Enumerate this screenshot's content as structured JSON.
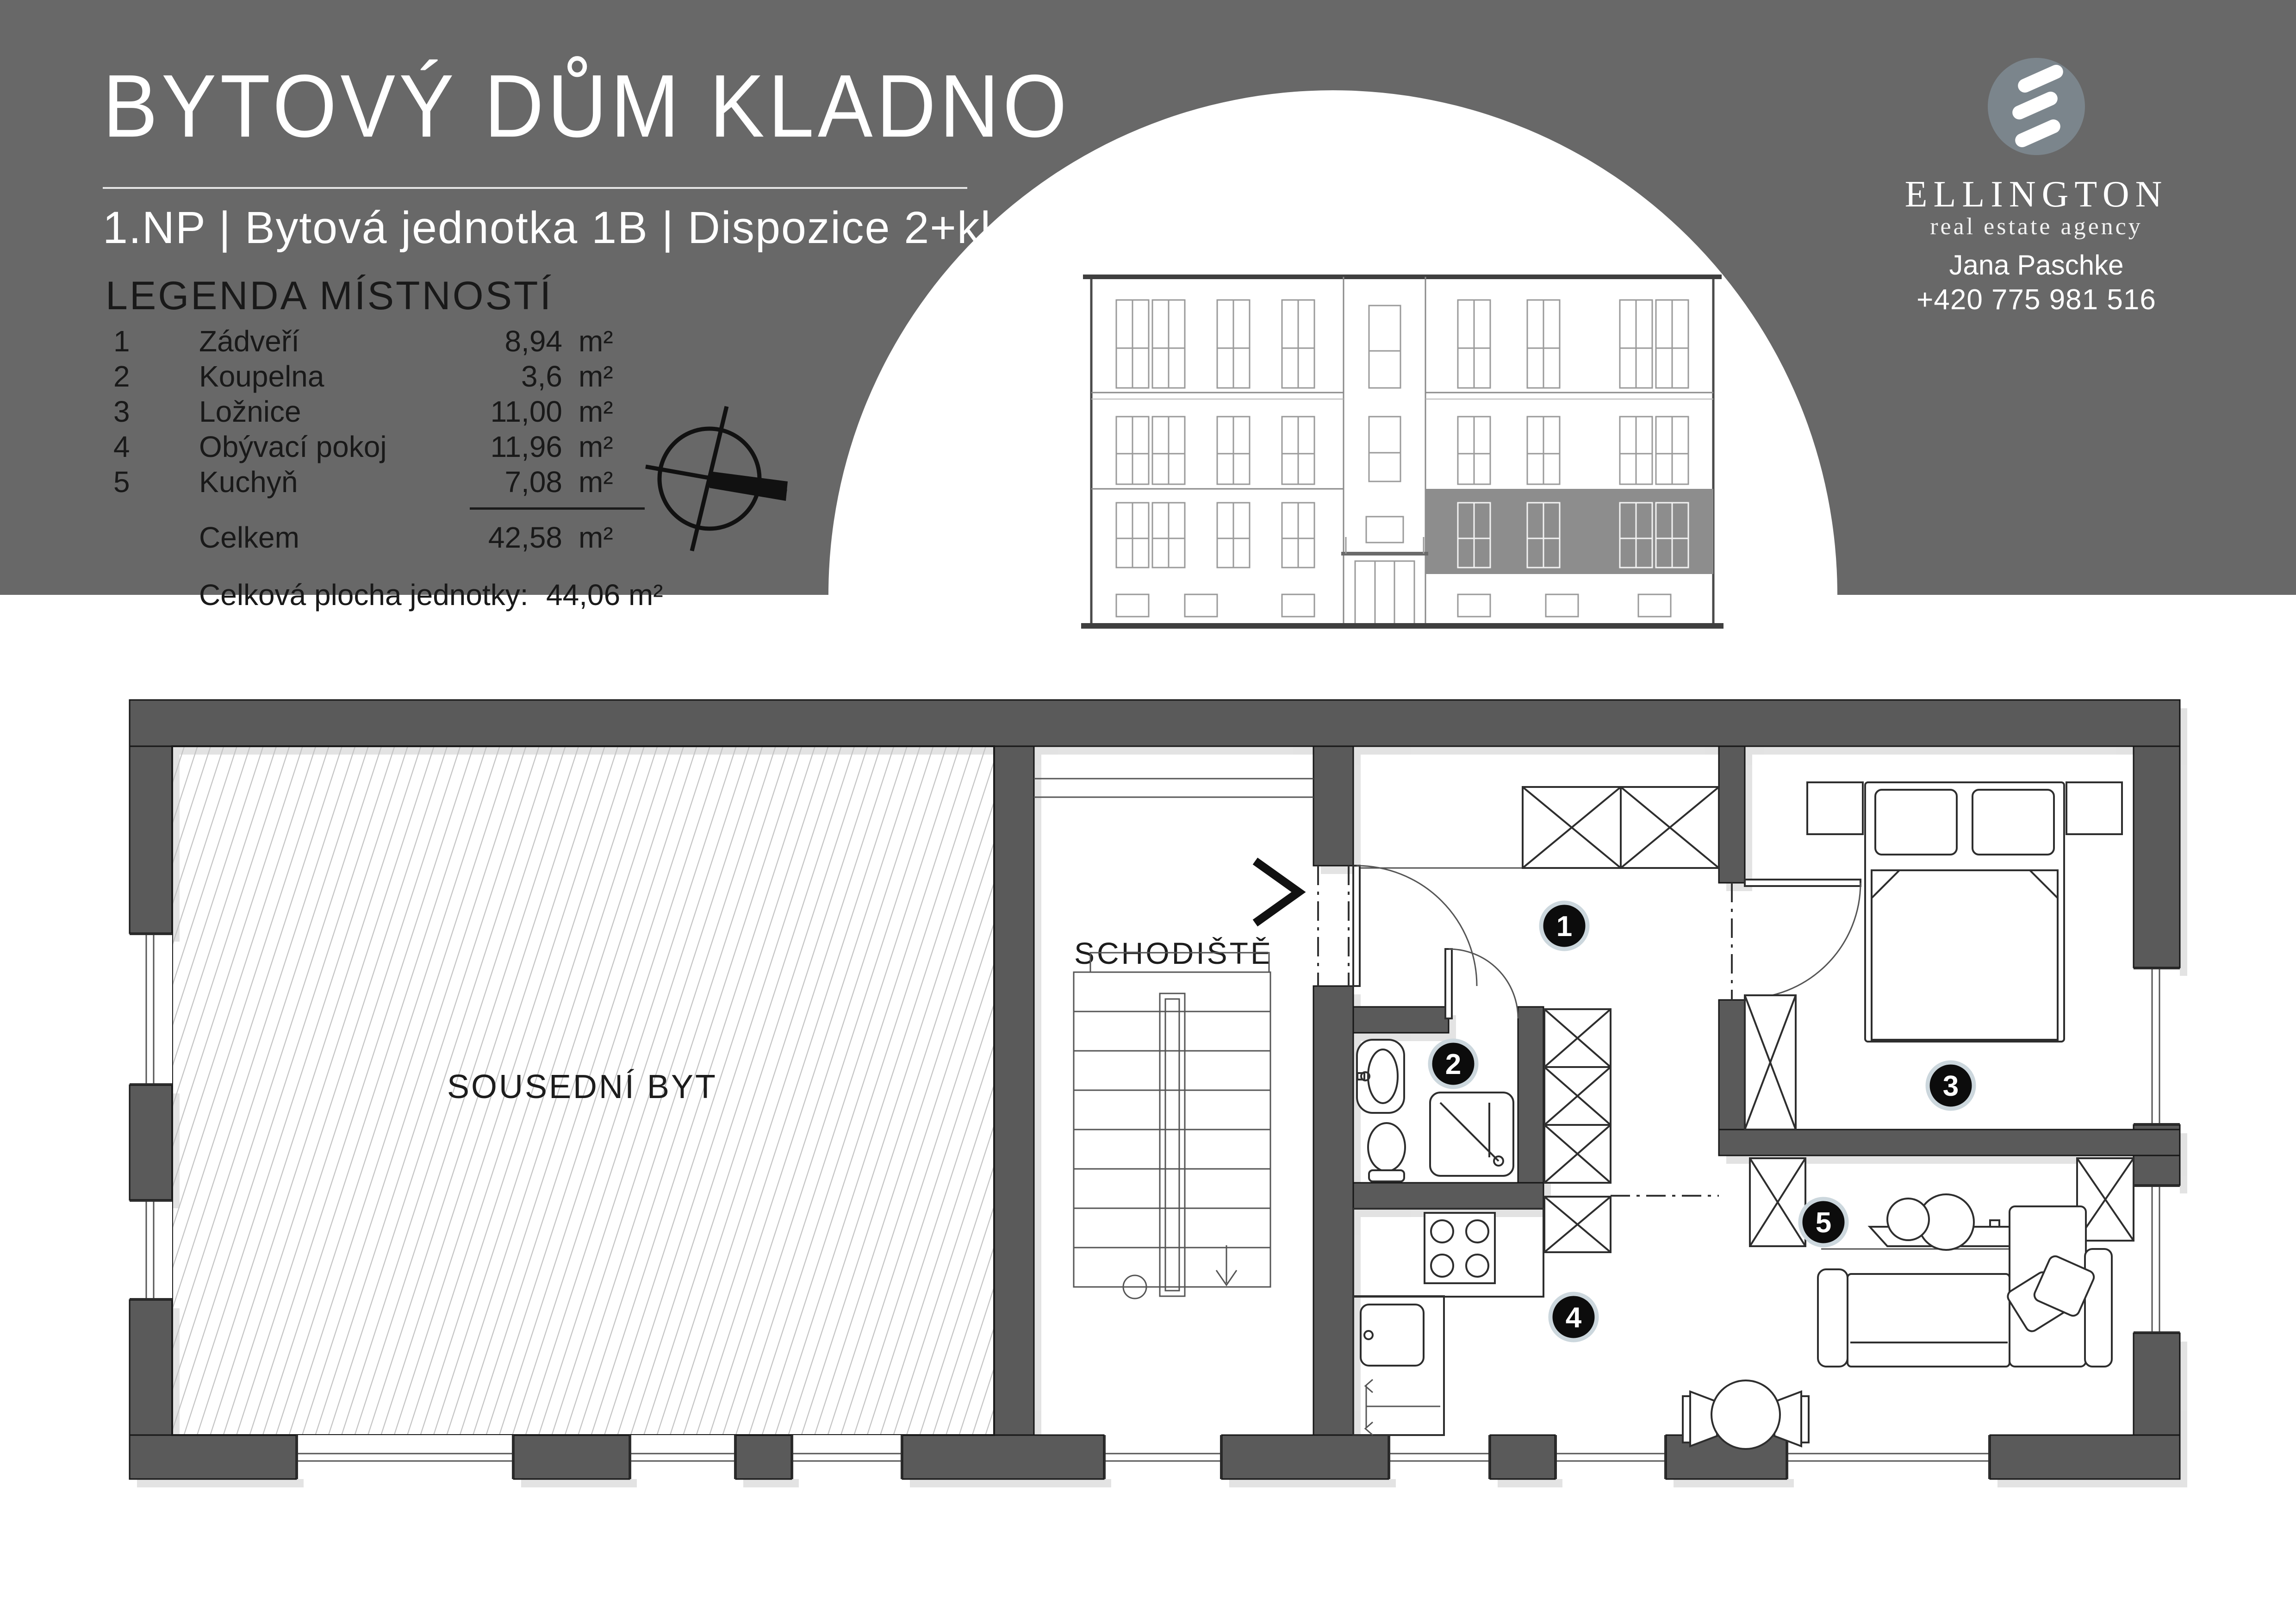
{
  "header": {
    "title": "BYTOVÝ DŮM KLADNO",
    "subtitle": "1.NP | Bytová jednotka 1B | Dispozice 2+kk",
    "legend": {
      "heading": "LEGENDA MÍSTNOSTÍ",
      "rooms": [
        {
          "num": "1",
          "name": "Zádveří",
          "area": "8,94",
          "unit": "m²"
        },
        {
          "num": "2",
          "name": "Koupelna",
          "area": "3,6",
          "unit": "m²"
        },
        {
          "num": "3",
          "name": "Ložnice",
          "area": "11,00",
          "unit": "m²"
        },
        {
          "num": "4",
          "name": "Obývací pokoj",
          "area": "11,96",
          "unit": "m²"
        },
        {
          "num": "5",
          "name": "Kuchyň",
          "area": "7,08",
          "unit": "m²"
        }
      ],
      "total_label": "Celkem",
      "total_area": "42,58",
      "total_unit": "m²",
      "grand_label": "Celková plocha jednotky:",
      "grand_value": "44,06 m²"
    }
  },
  "agency": {
    "name": "ELLINGTON",
    "tagline": "real estate agency",
    "agent": "Jana Paschke",
    "phone": "+420 775 981 516"
  },
  "plan": {
    "labels": {
      "neighbor_flat": "SOUSEDNÍ BYT",
      "staircase": "SCHODIŠTĚ"
    },
    "room_numbers": [
      "1",
      "2",
      "3",
      "4",
      "5"
    ]
  },
  "icons": {
    "north_arrow": "compass-north-arrow",
    "entrance_chevron": ">"
  },
  "colors": {
    "header_bg": "#686868",
    "wall": "#5a5a5a",
    "logo_circle": "#7b858c",
    "facade_highlight": "#8d8d8d",
    "hatch_line": "#c2c2c2"
  }
}
